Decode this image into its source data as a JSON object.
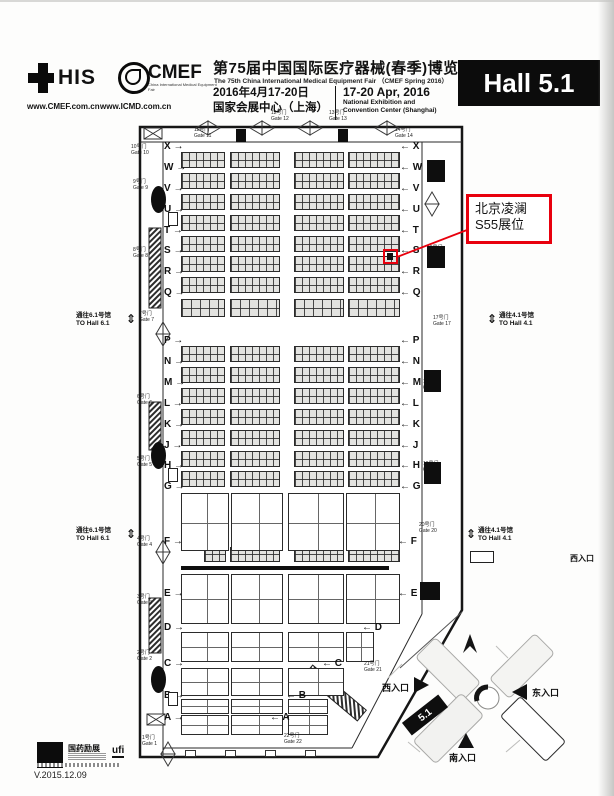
{
  "header": {
    "this_his": "HIS",
    "url_cmef": "www.CMEF.com.cn",
    "url_icmd": "www.ICMD.com.cn",
    "cmef": "CMEF",
    "cmef_tagline": "China International Medical Equipment Fair",
    "title_cn": "第75届中国国际医疗器械(春季)博览会",
    "title_en": "The 75th China International Medical Equipment Fair （CMEF Spring 2016）",
    "date_cn": "2016年4月17-20日",
    "venue_cn": "国家会展中心（上海）",
    "date_en": "17-20 Apr, 2016",
    "venue_en_line1": "National Exhibition and",
    "venue_en_line2": "Convention Center (Shanghai)",
    "hall": "Hall 5.1"
  },
  "annotation": {
    "line1": "北京凌澜",
    "line2": "S55展位",
    "accent_color": "#e8000d"
  },
  "passages": {
    "left_cn": "通往6.1号馆",
    "left_en": "TO Hall 6.1",
    "right_cn": "通往4.1号馆",
    "right_en": "TO Hall 4.1",
    "arrow": "⇕"
  },
  "plan": {
    "row_letters": [
      "X",
      "W",
      "V",
      "U",
      "T",
      "S",
      "R",
      "Q",
      "P",
      "N",
      "M",
      "L",
      "K",
      "J",
      "H",
      "G",
      "F",
      "E",
      "D",
      "C",
      "B",
      "A"
    ],
    "arrow_right": "→",
    "arrow_left": "←",
    "gates": [
      {
        "cn": "1号门",
        "en": "Gate 1"
      },
      {
        "cn": "2号门",
        "en": "Gate 2"
      },
      {
        "cn": "3号门",
        "en": "Gate 3"
      },
      {
        "cn": "4号门",
        "en": "Gate 4"
      },
      {
        "cn": "5号门",
        "en": "Gate 5"
      },
      {
        "cn": "6号门",
        "en": "Gate 6"
      },
      {
        "cn": "7号门",
        "en": "Gate 7"
      },
      {
        "cn": "8号门",
        "en": "Gate 8"
      },
      {
        "cn": "9号门",
        "en": "Gate 9"
      },
      {
        "cn": "10号门",
        "en": "Gate 10"
      },
      {
        "cn": "11号门",
        "en": "Gate 11"
      },
      {
        "cn": "12号门",
        "en": "Gate 12"
      },
      {
        "cn": "13号门",
        "en": "Gate 13"
      },
      {
        "cn": "14号门",
        "en": "Gate 14"
      },
      {
        "cn": "15号门",
        "en": "Gate 15"
      },
      {
        "cn": "16号门",
        "en": "Gate 16"
      },
      {
        "cn": "17号门",
        "en": "Gate 17"
      },
      {
        "cn": "18号门",
        "en": "Gate 18"
      },
      {
        "cn": "19号门",
        "en": "Gate 19"
      },
      {
        "cn": "20号门",
        "en": "Gate 20"
      },
      {
        "cn": "21号门",
        "en": "Gate 21"
      },
      {
        "cn": "22号门",
        "en": "Gate 22"
      }
    ]
  },
  "minimap": {
    "hall": "5.1",
    "west": "西入口",
    "east": "东入口",
    "south": "南入口",
    "west_edge": "西入口"
  },
  "footer": {
    "brand_cn": "国药励展",
    "ufi": "ufi",
    "version": "V.2015.12.09"
  }
}
